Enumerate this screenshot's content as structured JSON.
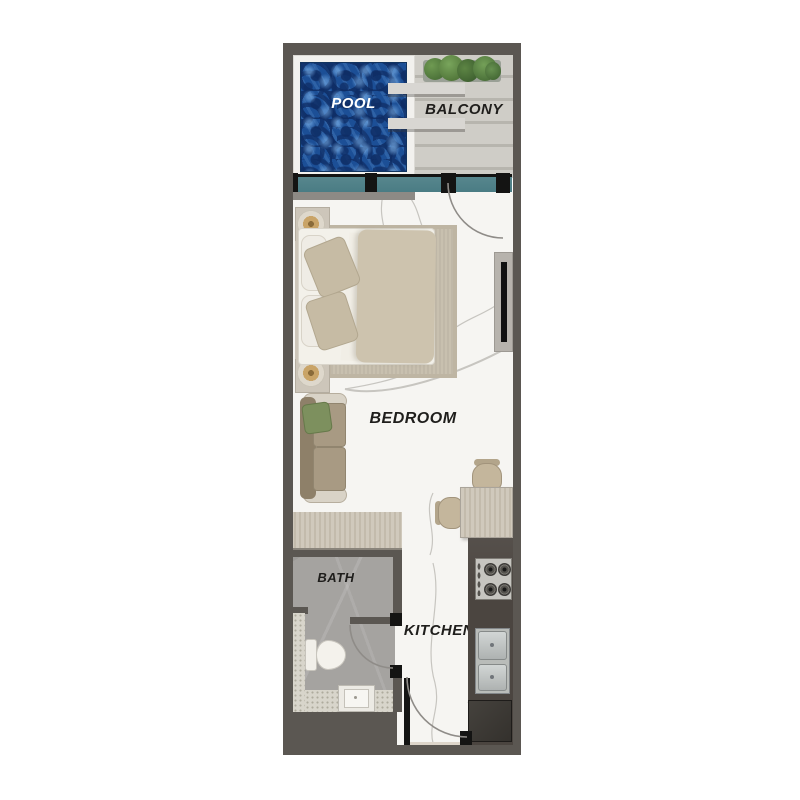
{
  "title": "Studio apartment floor plan",
  "labels": {
    "pool": "POOL",
    "balcony": "BALCONY",
    "bedroom": "BEDROOM",
    "bath": "BATH",
    "kitchen": "KITCHEN"
  },
  "colors": {
    "wall": "#5b5752",
    "black": "#141413",
    "glass": "#4a7c84",
    "pool-mid": "#1c4f96",
    "balcony-wood": "#cfcdc7",
    "plank-gap": "#b7b5ae",
    "marble": "#f6f5f2",
    "vein": "#c2c0bb",
    "rug": "#c8c0af",
    "bed-linen": "#f3f1ea",
    "duvet": "#cdc3ae",
    "pillow": "#c6bba4",
    "head-wood": "#cdc6ba",
    "sofa-back": "#8e8069",
    "sofa-seat": "#a89a83",
    "sofa-arm": "#d9d3c7",
    "pillow-green": "#7d905e",
    "table-wood": "#d0c9bc",
    "chair": "#c4b69c",
    "tile": "#a5a3a0",
    "tile-light": "#d8d5cb",
    "counter": "#4b4540",
    "steel": "#c8cccb",
    "appliance": "#34312d",
    "mat": "#ddd5ca",
    "plant": "#5d8544",
    "plant-dark": "#3f6330",
    "lamp": "#c9a468",
    "arc": "#8f8c88"
  }
}
